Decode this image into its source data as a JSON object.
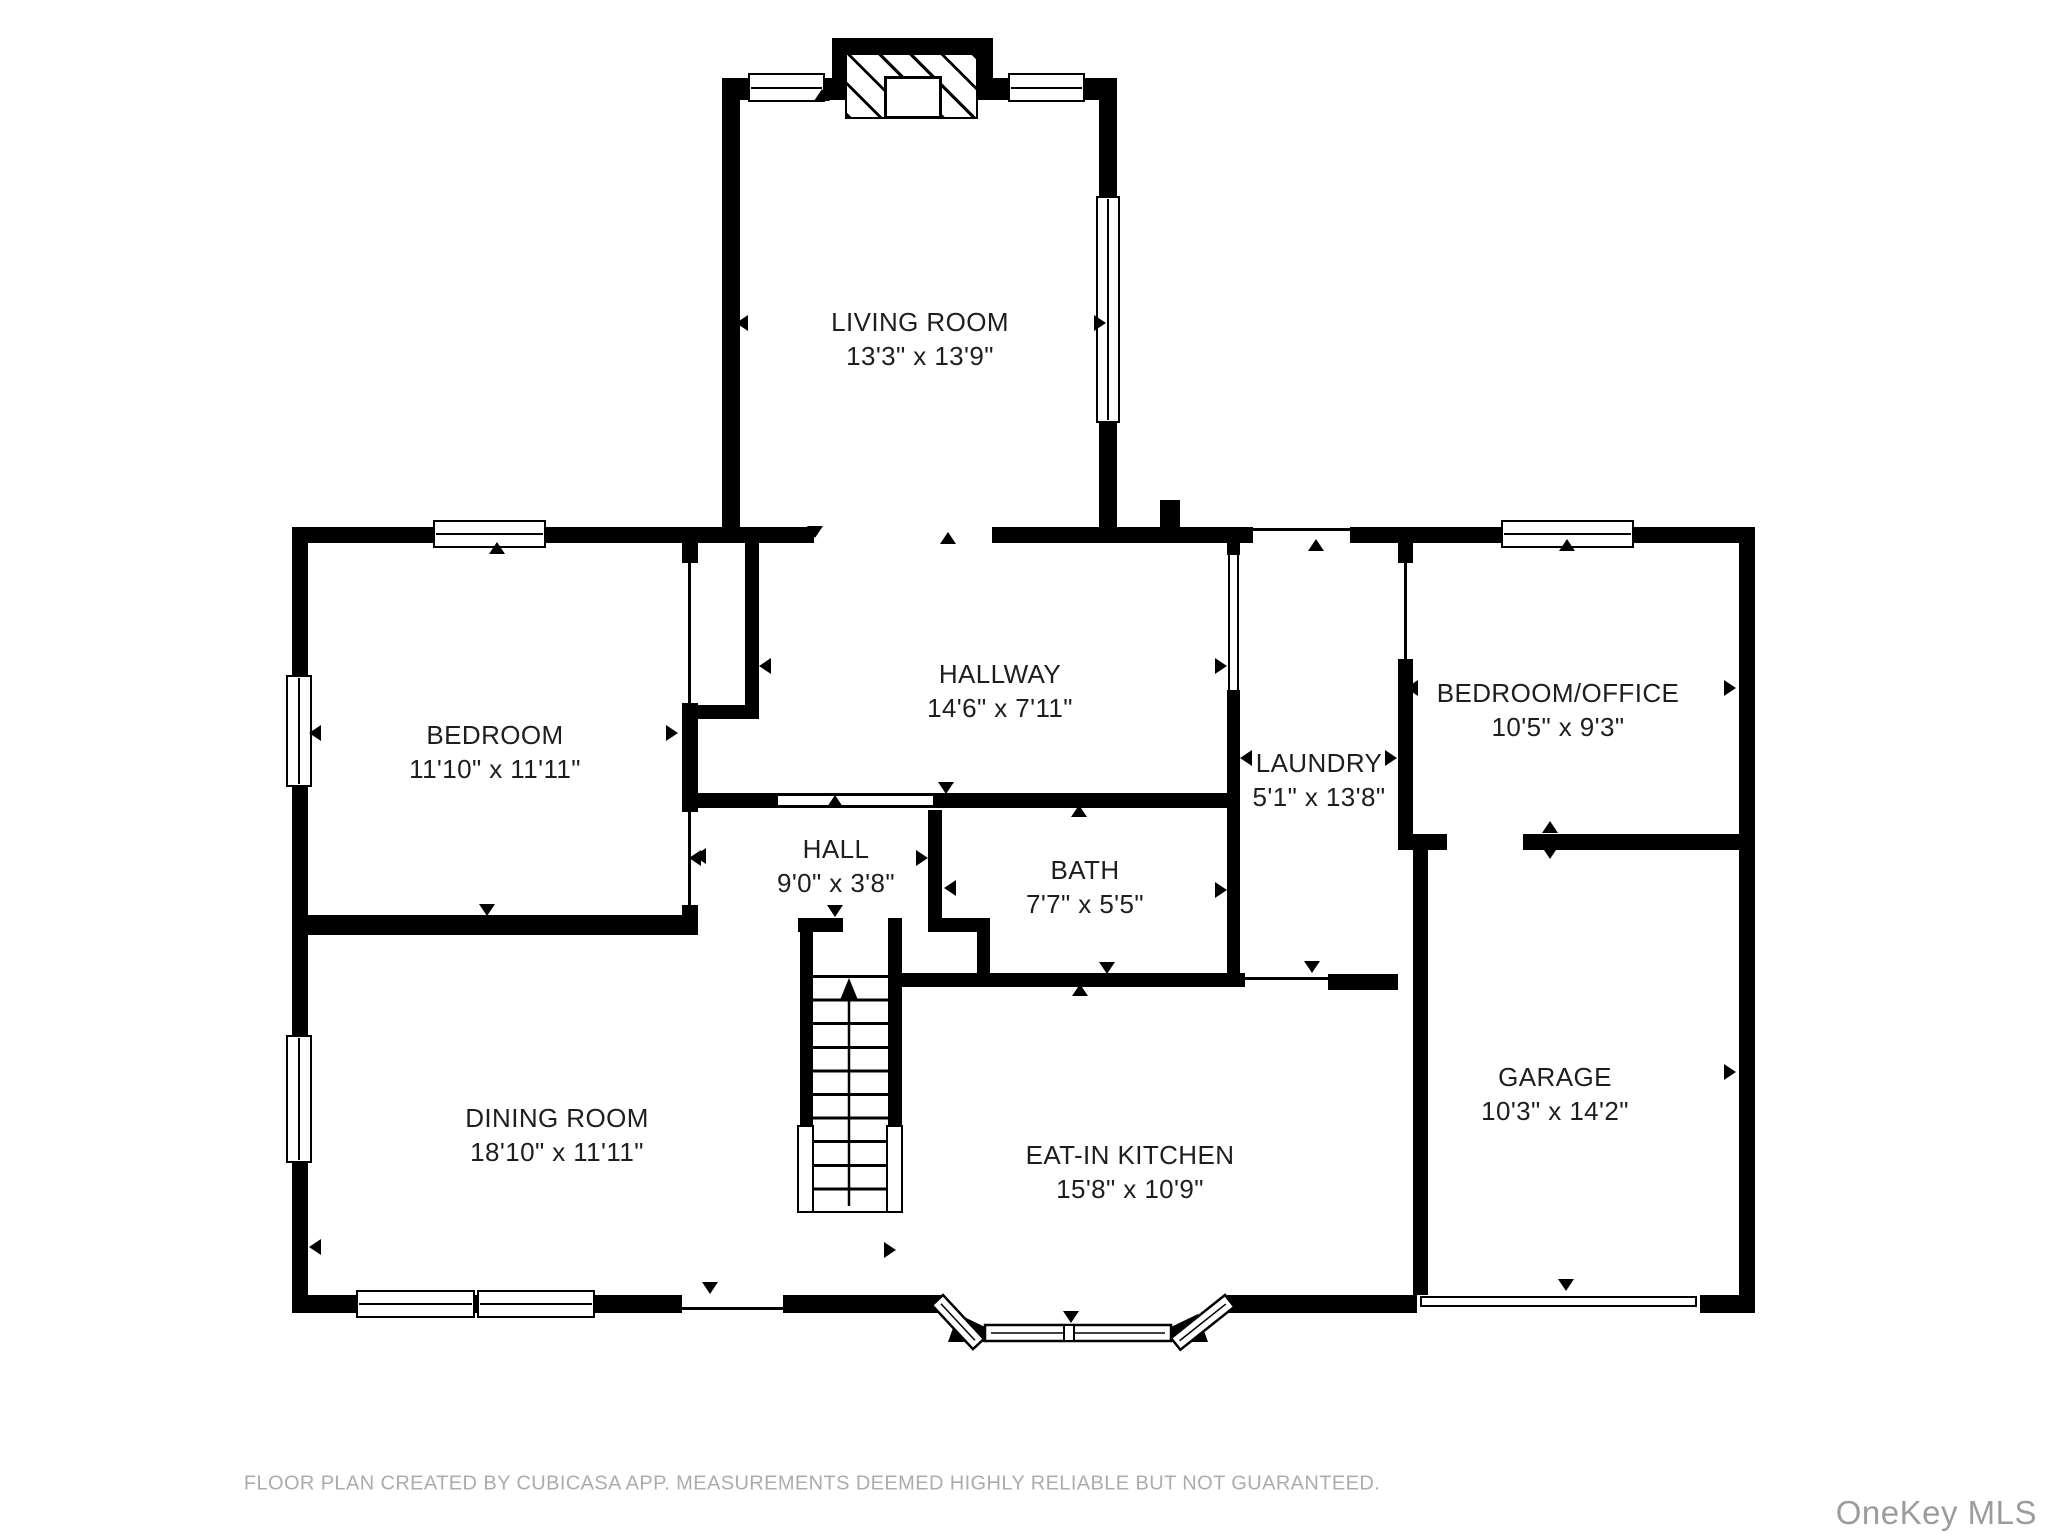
{
  "footer": {
    "disclaimer": "FLOOR PLAN CREATED BY CUBICASA APP. MEASUREMENTS DEEMED HIGHLY RELIABLE BUT NOT GUARANTEED."
  },
  "watermark": "OneKey MLS",
  "colors": {
    "wall": "#000000",
    "label_text": "#1e1e1e",
    "footer_text": "#acacac",
    "watermark_text": "#9c9c9c"
  },
  "rooms": [
    {
      "id": "living-room",
      "name": "LIVING ROOM",
      "dims": "13'3\" x 13'9\"",
      "x": 920,
      "y": 339
    },
    {
      "id": "bedroom",
      "name": "BEDROOM",
      "dims": "11'10\" x 11'11\"",
      "x": 495,
      "y": 752
    },
    {
      "id": "hallway",
      "name": "HALLWAY",
      "dims": "14'6\" x 7'11\"",
      "x": 1000,
      "y": 691
    },
    {
      "id": "laundry",
      "name": "LAUNDRY",
      "dims": "5'1\" x 13'8\"",
      "x": 1319,
      "y": 780
    },
    {
      "id": "bedroom-office",
      "name": "BEDROOM/OFFICE",
      "dims": "10'5\" x 9'3\"",
      "x": 1558,
      "y": 710
    },
    {
      "id": "hall",
      "name": "HALL",
      "dims": "9'0\" x 3'8\"",
      "x": 836,
      "y": 866
    },
    {
      "id": "bath",
      "name": "BATH",
      "dims": "7'7\" x 5'5\"",
      "x": 1085,
      "y": 887
    },
    {
      "id": "dining-room",
      "name": "DINING ROOM",
      "dims": "18'10\" x 11'11\"",
      "x": 557,
      "y": 1135
    },
    {
      "id": "eat-in-kitchen",
      "name": "EAT-IN KITCHEN",
      "dims": "15'8\" x 10'9\"",
      "x": 1130,
      "y": 1172
    },
    {
      "id": "garage",
      "name": "GARAGE",
      "dims": "10'3\" x 14'2\"",
      "x": 1555,
      "y": 1094
    }
  ],
  "arrows": [
    {
      "d": "down",
      "x": 815,
      "y": 532
    },
    {
      "d": "up",
      "x": 948,
      "y": 538
    },
    {
      "d": "left",
      "x": 742,
      "y": 323
    },
    {
      "d": "right",
      "x": 1100,
      "y": 323
    },
    {
      "d": "up",
      "x": 822,
      "y": 95
    },
    {
      "d": "up",
      "x": 1316,
      "y": 545
    },
    {
      "d": "up",
      "x": 497,
      "y": 548
    },
    {
      "d": "left",
      "x": 315,
      "y": 733
    },
    {
      "d": "right",
      "x": 672,
      "y": 733
    },
    {
      "d": "down",
      "x": 487,
      "y": 910
    },
    {
      "d": "left",
      "x": 695,
      "y": 858
    },
    {
      "d": "right",
      "x": 1221,
      "y": 666
    },
    {
      "d": "left",
      "x": 765,
      "y": 666
    },
    {
      "d": "down",
      "x": 946,
      "y": 788
    },
    {
      "d": "up",
      "x": 835,
      "y": 801
    },
    {
      "d": "left",
      "x": 700,
      "y": 856
    },
    {
      "d": "right",
      "x": 922,
      "y": 858
    },
    {
      "d": "up",
      "x": 1079,
      "y": 811
    },
    {
      "d": "left",
      "x": 950,
      "y": 888
    },
    {
      "d": "right",
      "x": 1221,
      "y": 890
    },
    {
      "d": "down",
      "x": 835,
      "y": 911
    },
    {
      "d": "left",
      "x": 1246,
      "y": 758
    },
    {
      "d": "right",
      "x": 1391,
      "y": 758
    },
    {
      "d": "down",
      "x": 1312,
      "y": 967
    },
    {
      "d": "down",
      "x": 1107,
      "y": 968
    },
    {
      "d": "up",
      "x": 1080,
      "y": 990
    },
    {
      "d": "left",
      "x": 1412,
      "y": 688
    },
    {
      "d": "right",
      "x": 1730,
      "y": 688
    },
    {
      "d": "up",
      "x": 1567,
      "y": 545
    },
    {
      "d": "up",
      "x": 1550,
      "y": 827
    },
    {
      "d": "down",
      "x": 1550,
      "y": 853
    },
    {
      "d": "right",
      "x": 1730,
      "y": 1072
    },
    {
      "d": "down",
      "x": 1566,
      "y": 1285
    },
    {
      "d": "left",
      "x": 315,
      "y": 1247
    },
    {
      "d": "down",
      "x": 710,
      "y": 1288
    },
    {
      "d": "right",
      "x": 890,
      "y": 1250
    },
    {
      "d": "down",
      "x": 1071,
      "y": 1317
    }
  ]
}
